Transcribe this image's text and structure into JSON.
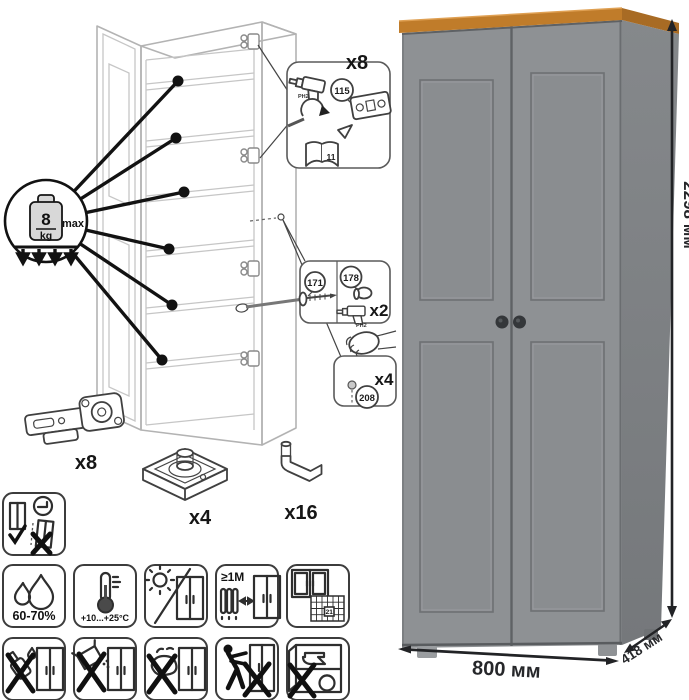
{
  "diagram": {
    "weight_limit": {
      "value": "8",
      "unit": "kg",
      "qualifier": "max"
    },
    "hinge_callout": {
      "count": "x8",
      "part_id": "115",
      "bit": "PH2",
      "manual_page": "11"
    },
    "screw_callout": {
      "count": "x2",
      "screw_part": "171",
      "cap_part": "178",
      "bit": "PH2"
    },
    "cap_callout": {
      "count": "x4",
      "part_id": "208"
    },
    "hardware": {
      "hinge_count": "x8",
      "foot_count": "x4",
      "pin_count": "x16"
    }
  },
  "care": {
    "humidity": "60-70%",
    "temperature": "+10...+25°C",
    "heater_distance": "≥1М",
    "ventilation_day": "21"
  },
  "wardrobe": {
    "height": "2298 мм",
    "width": "800 мм",
    "depth": "418 мм"
  },
  "icons": {
    "weight": "weight-8kg-max",
    "humidity": "water-drops",
    "temperature": "thermometer",
    "sunlight": "sun-crossed",
    "heater": "radiator-distance",
    "ventilation": "open-window-calendar",
    "no_liquids": "crossed-bottle",
    "no_abrasives": "crossed-powder-box",
    "no_scrubbing": "crossed-sponge",
    "no_dragging": "crossed-person-pushing",
    "no_heavy_items": "crossed-anvil-in-cabinet",
    "wall_anchor": "cabinet-wall-fixing"
  },
  "colors": {
    "door_front": "#8e9194",
    "door_panel": "#8a8d90",
    "side_panel": "#7c7f82",
    "wood_top": "#c07c2a",
    "wood_side": "#a86b24",
    "knob": "#34373a",
    "dim_line": "#222326"
  }
}
